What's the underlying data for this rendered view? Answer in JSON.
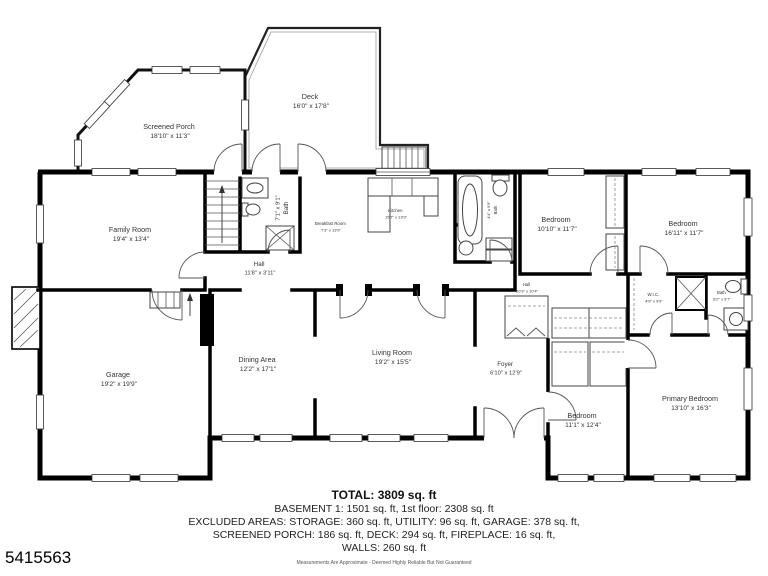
{
  "plan": {
    "rooms": [
      {
        "id": "screened_porch",
        "name": "Screened Porch",
        "dims": "18'10\" x 11'3\""
      },
      {
        "id": "deck",
        "name": "Deck",
        "dims": "16'0\" x 17'8\""
      },
      {
        "id": "family_room",
        "name": "Family Room",
        "dims": "19'4\" x 13'4\""
      },
      {
        "id": "bath_1",
        "name": "Bath",
        "dims": "7'1\" x 9'1\""
      },
      {
        "id": "breakfast_room",
        "name": "Breakfast Room",
        "dims": "7'3\" x 13'9\""
      },
      {
        "id": "kitchen",
        "name": "Kitchen",
        "dims": "15'7\" x 13'9\""
      },
      {
        "id": "bath_2",
        "name": "Bath",
        "dims": "4'4\" x 9'9\""
      },
      {
        "id": "bedroom_1",
        "name": "Bedroom",
        "dims": "10'10\" x 11'7\""
      },
      {
        "id": "bedroom_2",
        "name": "Bedroom",
        "dims": "16'11\" x 11'7\""
      },
      {
        "id": "hall_1",
        "name": "Hall",
        "dims": "11'8\" x 3'11\""
      },
      {
        "id": "hall_2",
        "name": "Hall",
        "dims": "20'3\" x 10'4\""
      },
      {
        "id": "wic",
        "name": "W.I.C.",
        "dims": "4'9\" x 9'9\""
      },
      {
        "id": "bath_3",
        "name": "Bath",
        "dims": "8'2\" x 9'7\""
      },
      {
        "id": "garage",
        "name": "Garage",
        "dims": "19'2\" x 19'9\""
      },
      {
        "id": "dining_area",
        "name": "Dining Area",
        "dims": "12'2\" x 17'1\""
      },
      {
        "id": "living_room",
        "name": "Living Room",
        "dims": "19'2\" x 15'5\""
      },
      {
        "id": "foyer",
        "name": "Foyer",
        "dims": "6'10\" x 12'9\""
      },
      {
        "id": "bedroom_3",
        "name": "Bedroom",
        "dims": "11'1\" x 12'4\""
      },
      {
        "id": "primary_bedroom",
        "name": "Primary Bedroom",
        "dims": "13'10\" x 16'3\""
      }
    ]
  },
  "summary": {
    "total": "TOTAL: 3809 sq. ft",
    "line_basement": "BASEMENT 1: 1501 sq. ft, 1st floor: 2308 sq. ft",
    "line_excluded": "EXCLUDED AREAS: STORAGE: 360 sq. ft, UTILITY: 96 sq. ft, GARAGE: 378 sq. ft,",
    "line_porch_deck": "SCREENED PORCH: 186 sq. ft, DECK: 294 sq. ft, FIREPLACE: 16 sq. ft,",
    "line_walls": "WALLS: 260 sq. ft",
    "disclaimer": "Measurements Are Approximate - Deemed Highly Reliable But Not Guaranteed"
  },
  "listing_id": "5415563",
  "colors": {
    "wall": "#000000",
    "background": "#ffffff",
    "label": "#333333"
  }
}
